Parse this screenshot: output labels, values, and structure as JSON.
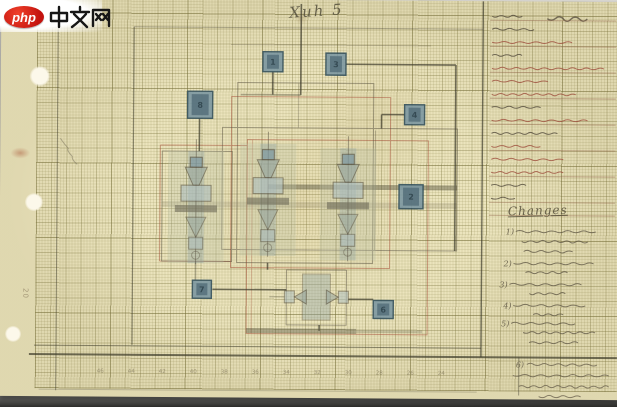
{
  "watermark": {
    "logo_badge": "php",
    "site_name": "中文网"
  },
  "page": {
    "signature_note": "Xuh 5",
    "stamp_number": "20"
  },
  "title_block": {
    "rows": [
      {
        "tone": "dark",
        "len": 26,
        "rule": true,
        "big": true
      },
      {
        "tone": "dark",
        "len": 38,
        "rule": false
      },
      {
        "tone": "red",
        "len": 78,
        "rule": true
      },
      {
        "tone": "dark",
        "len": 30,
        "rule": false
      },
      {
        "tone": "red",
        "len": 108,
        "rule": true
      },
      {
        "tone": "red",
        "len": 56,
        "rule": false
      },
      {
        "tone": "red",
        "len": 84,
        "rule": true
      },
      {
        "tone": "dark",
        "len": 46,
        "rule": false
      },
      {
        "tone": "red",
        "len": 96,
        "rule": true
      },
      {
        "tone": "dark",
        "len": 62,
        "rule": false
      },
      {
        "tone": "red",
        "len": 44,
        "rule": true
      },
      {
        "tone": "red",
        "len": 66,
        "rule": false
      },
      {
        "tone": "red",
        "len": 72,
        "rule": true
      },
      {
        "tone": "dark",
        "len": 34,
        "rule": false
      },
      {
        "tone": "dark",
        "len": 18,
        "rule": true
      },
      {
        "tone": "dark",
        "len": 0,
        "rule": true
      }
    ]
  },
  "changes": {
    "heading": "Changes",
    "items": [
      {
        "marker": "1)",
        "lines": [
          [
            516,
            230,
            80
          ],
          [
            522,
            240,
            64
          ],
          [
            524,
            250,
            46
          ]
        ]
      },
      {
        "marker": "2)",
        "lines": [
          [
            514,
            262,
            76
          ],
          [
            526,
            271,
            40
          ]
        ]
      },
      {
        "marker": "3)",
        "lines": [
          [
            510,
            283,
            70
          ],
          [
            530,
            292,
            34
          ]
        ]
      },
      {
        "marker": "4)",
        "lines": [
          [
            514,
            304,
            66
          ],
          [
            534,
            313,
            30
          ]
        ]
      },
      {
        "marker": "5)",
        "lines": [
          [
            512,
            322,
            58
          ],
          [
            524,
            331,
            70
          ],
          [
            530,
            341,
            44
          ]
        ]
      }
    ]
  },
  "footer_notes": {
    "marker": "6)",
    "lines": [
      [
        528,
        363,
        70
      ],
      [
        514,
        374,
        92
      ],
      [
        520,
        385,
        86
      ],
      [
        540,
        395,
        40
      ]
    ]
  },
  "ruler": {
    "numbers": [
      "46",
      "44",
      "42",
      "40",
      "38",
      "36",
      "34",
      "32",
      "30",
      "28",
      "26",
      "24"
    ]
  },
  "diagram": {
    "terminals": [
      {
        "x": 262,
        "y": 52,
        "w": 20,
        "h": 20,
        "label": "1"
      },
      {
        "x": 325,
        "y": 53,
        "w": 20,
        "h": 22,
        "label": "3"
      },
      {
        "x": 187,
        "y": 92,
        "w": 25,
        "h": 27,
        "label": "8"
      },
      {
        "x": 404,
        "y": 104,
        "w": 20,
        "h": 20,
        "label": "4"
      },
      {
        "x": 399,
        "y": 184,
        "w": 24,
        "h": 24,
        "label": "2"
      },
      {
        "x": 193,
        "y": 281,
        "w": 19,
        "h": 18,
        "label": "7"
      },
      {
        "x": 374,
        "y": 300,
        "w": 20,
        "h": 18,
        "label": "6"
      }
    ],
    "tube_units": [
      {
        "cx": 196,
        "top": 160
      },
      {
        "cx": 268,
        "top": 152
      },
      {
        "cx": 348,
        "top": 156
      }
    ]
  },
  "colors": {
    "paper": "#ebe4bd",
    "ink": "#3c3a2a",
    "pencil": "#57503f",
    "red": "#9a4636",
    "terminal_fill": "#7d98a2",
    "terminal_border": "#33505c",
    "shade_green": "#b9bfa6",
    "shade_blue": "#8fa3a4",
    "logo_red": "#d8231f"
  }
}
